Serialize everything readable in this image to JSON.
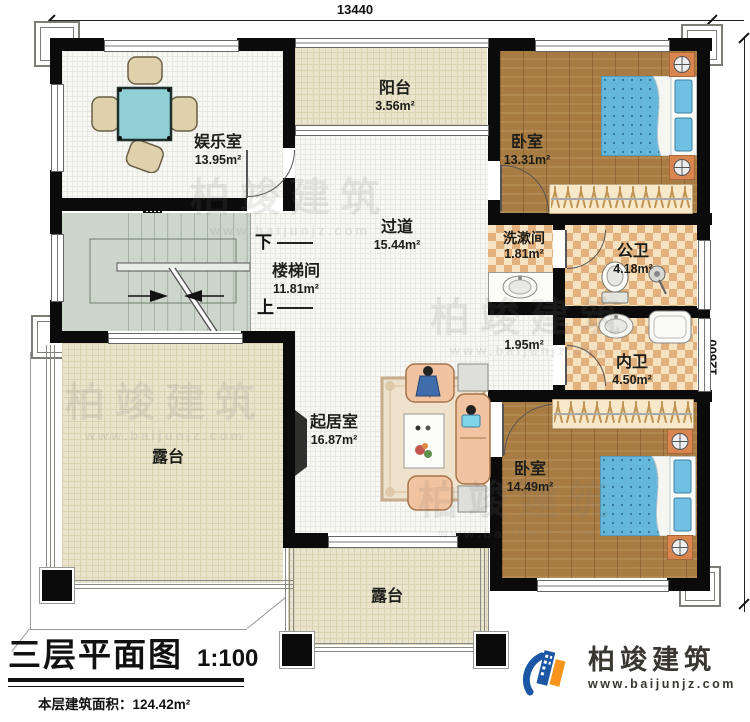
{
  "dimensions": {
    "top": "13440",
    "right": "12600"
  },
  "rooms": {
    "entertainment": {
      "name": "娱乐室",
      "area": "13.95m²"
    },
    "balcony": {
      "name": "阳台",
      "area": "3.56m²"
    },
    "bedroom_top": {
      "name": "卧室",
      "area": "13.31m²"
    },
    "corridor": {
      "name": "过道",
      "area": "15.44m²"
    },
    "stairwell": {
      "name": "楼梯间",
      "area": "11.81m²"
    },
    "washroom": {
      "name": "洗漱间",
      "area": "1.81m²"
    },
    "public_bath": {
      "name": "公卫",
      "area": "4.18m²"
    },
    "niche": {
      "area": "1.95m²"
    },
    "private_bath": {
      "name": "内卫",
      "area": "4.50m²"
    },
    "living": {
      "name": "起居室",
      "area": "16.87m²"
    },
    "bedroom_bottom": {
      "name": "卧室",
      "area": "14.49m²"
    },
    "terrace_left": {
      "name": "露台"
    },
    "terrace_bottom": {
      "name": "露台"
    }
  },
  "stairs": {
    "down": "下",
    "up": "上"
  },
  "title_block": {
    "title": "三层平面图",
    "scale": "1:100",
    "area_label": "本层建筑面积：",
    "area_value": "124.42m²",
    "height_label": "层高：",
    "height_value": "3.3m"
  },
  "brand": {
    "name": "柏竣建筑",
    "url": "www.baijunjz.com"
  },
  "watermark": {
    "name": "柏竣建筑",
    "url": "www.baijunjz.com"
  },
  "colors": {
    "wall": "#0b0b0b",
    "wood": "#a87b42",
    "tile_light": "#f6e3c2",
    "tile_dark": "#e3b17e",
    "bed": "#66b8da",
    "floor": "#f7f7f4",
    "terrace": "#eae4cc",
    "stair": "#ccd6ca",
    "brand_blue": "#1c57a5",
    "brand_orange": "#f7941e"
  }
}
